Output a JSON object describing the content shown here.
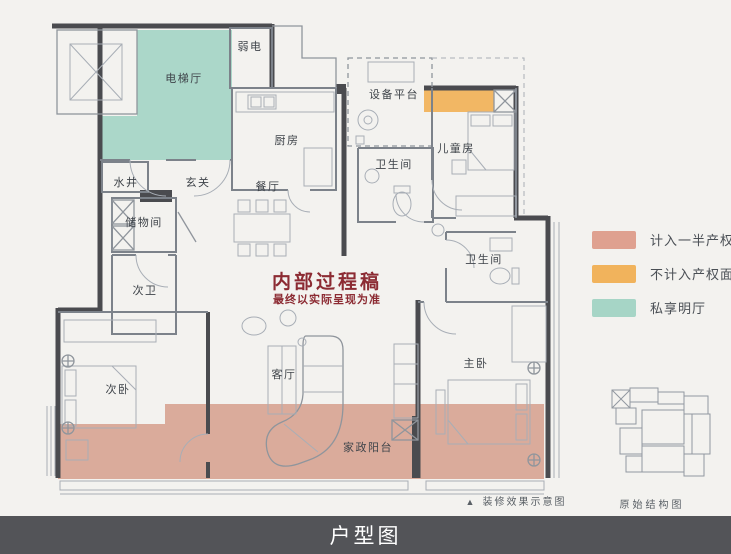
{
  "colors": {
    "paper": "#F3F2EF",
    "wall_dark": "#4A4B4F",
    "line_gray": "#8F959C",
    "watermark_red": "#8C2B33",
    "footer_bg": "#535458",
    "footer_text": "#FFFFFF"
  },
  "plan": {
    "rooms": [
      {
        "id": "elevator-hall",
        "label": "电梯厅"
      },
      {
        "id": "weak-electric",
        "label": "弱电"
      },
      {
        "id": "water-well",
        "label": "水井"
      },
      {
        "id": "entry",
        "label": "玄关"
      },
      {
        "id": "kitchen",
        "label": "厨房"
      },
      {
        "id": "dining-room",
        "label": "餐厅"
      },
      {
        "id": "storage-room",
        "label": "储物间"
      },
      {
        "id": "second-bathroom",
        "label": "次卫"
      },
      {
        "id": "equipment-platform",
        "label": "设备平台"
      },
      {
        "id": "bathroom-top",
        "label": "卫生间"
      },
      {
        "id": "kids-room",
        "label": "儿童房"
      },
      {
        "id": "bathroom-right",
        "label": "卫生间"
      },
      {
        "id": "second-bedroom",
        "label": "次卧"
      },
      {
        "id": "living-room",
        "label": "客厅"
      },
      {
        "id": "master-bedroom",
        "label": "主卧"
      },
      {
        "id": "service-balcony",
        "label": "家政阳台"
      }
    ],
    "watermark": {
      "line1": "内部过程稿",
      "line2": "最终以实际呈现为准"
    }
  },
  "legend": {
    "items": [
      {
        "label": "计入一半产权面积",
        "color": "#DFA190"
      },
      {
        "label": "不计入产权面积",
        "color": "#F1B35C"
      },
      {
        "label": "私享明厅",
        "color": "#A6D5C6"
      }
    ]
  },
  "captions": {
    "effect_marker": "▲",
    "effect_text": "装修效果示意图",
    "original_text": "原始结构图"
  },
  "footer": {
    "title": "户型图"
  }
}
